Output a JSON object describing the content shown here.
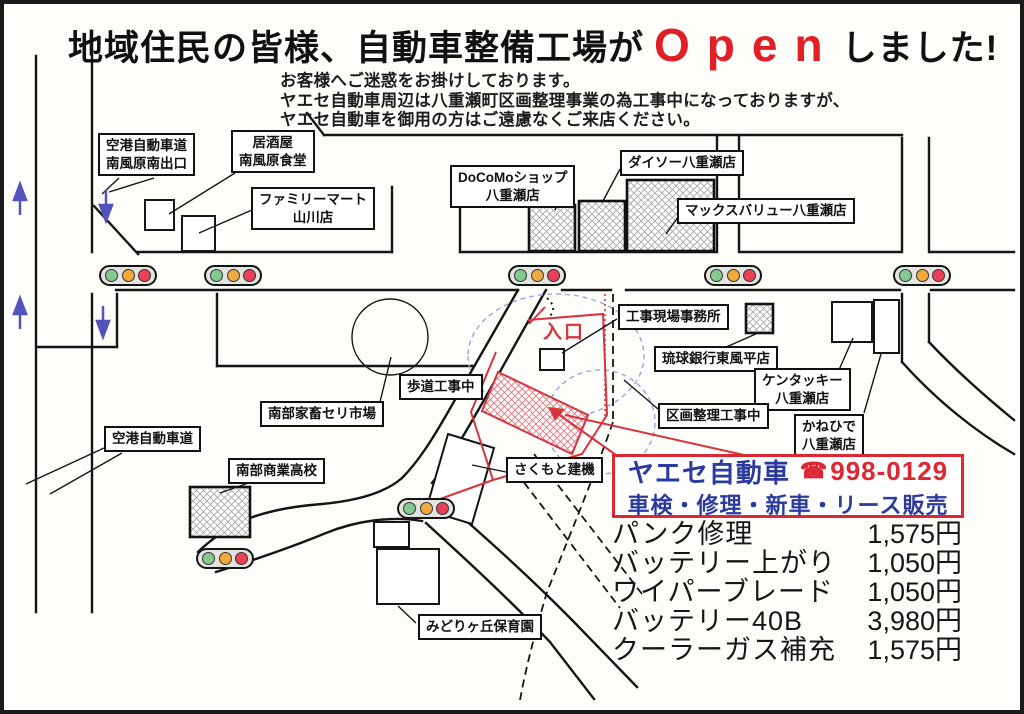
{
  "colors": {
    "open_red": "#e01f26",
    "shop_blue": "#2b3a9e",
    "shop_red": "#dd2733",
    "entrance_red": "#d93340",
    "signal_green": "#84ca8e",
    "signal_yellow": "#f2a93b",
    "signal_red": "#ea4156",
    "arrow_blue": "#5353bb"
  },
  "headline": {
    "prefix": "地域住民の皆様、自動車整備工場が",
    "open": "Open",
    "suffix": "しました!"
  },
  "notice": {
    "lines": [
      "お客様へご迷惑をお掛けしております。",
      "ヤエセ自動車周辺は八重瀬町区画整理事業の為工事中になっておりますが、",
      "ヤエセ自動車を御用の方はご遠慮なくご来店ください。"
    ]
  },
  "map": {
    "labels": {
      "airport_exit": "空港自動車道\n南風原南出口",
      "izakaya": "居酒屋\n南風原食堂",
      "familymart": "ファミリーマート\n山川店",
      "docomo": "DoCoMoショップ\n八重瀬店",
      "daiso": "ダイソー八重瀬店",
      "maxvalu": "マックスバリュー八重瀬店",
      "site_office": "工事現場事務所",
      "ryukyu_bank": "琉球銀行東風平店",
      "kentucky": "ケンタッキー\n八重瀬店",
      "kanehide": "かねひで\n八重瀬店",
      "kukaku_kouji": "区画整理工事中",
      "hodou_kouji": "歩道工事中",
      "cattle_market": "南部家畜セリ市場",
      "airport_road": "空港自動車道",
      "nanbu_high_school": "南部商業高校",
      "sakumoto": "さくもと建機",
      "midorigaoka": "みどりヶ丘保育園",
      "entrance": "入口"
    }
  },
  "shop_box": {
    "name": "ヤエセ自動車",
    "phone_icon": "☎",
    "phone": "998-0129",
    "services": "車検・修理・新車・リース販売"
  },
  "price_list": {
    "items": [
      {
        "name": "パンク修理",
        "price": "1,575円"
      },
      {
        "name": "バッテリー上がり",
        "price": "1,050円"
      },
      {
        "name": "ワイパーブレード",
        "price": "1,050円"
      },
      {
        "name": "バッテリー40B",
        "price": "3,980円"
      },
      {
        "name": "クーラーガス補充",
        "price": "1,575円"
      }
    ]
  }
}
